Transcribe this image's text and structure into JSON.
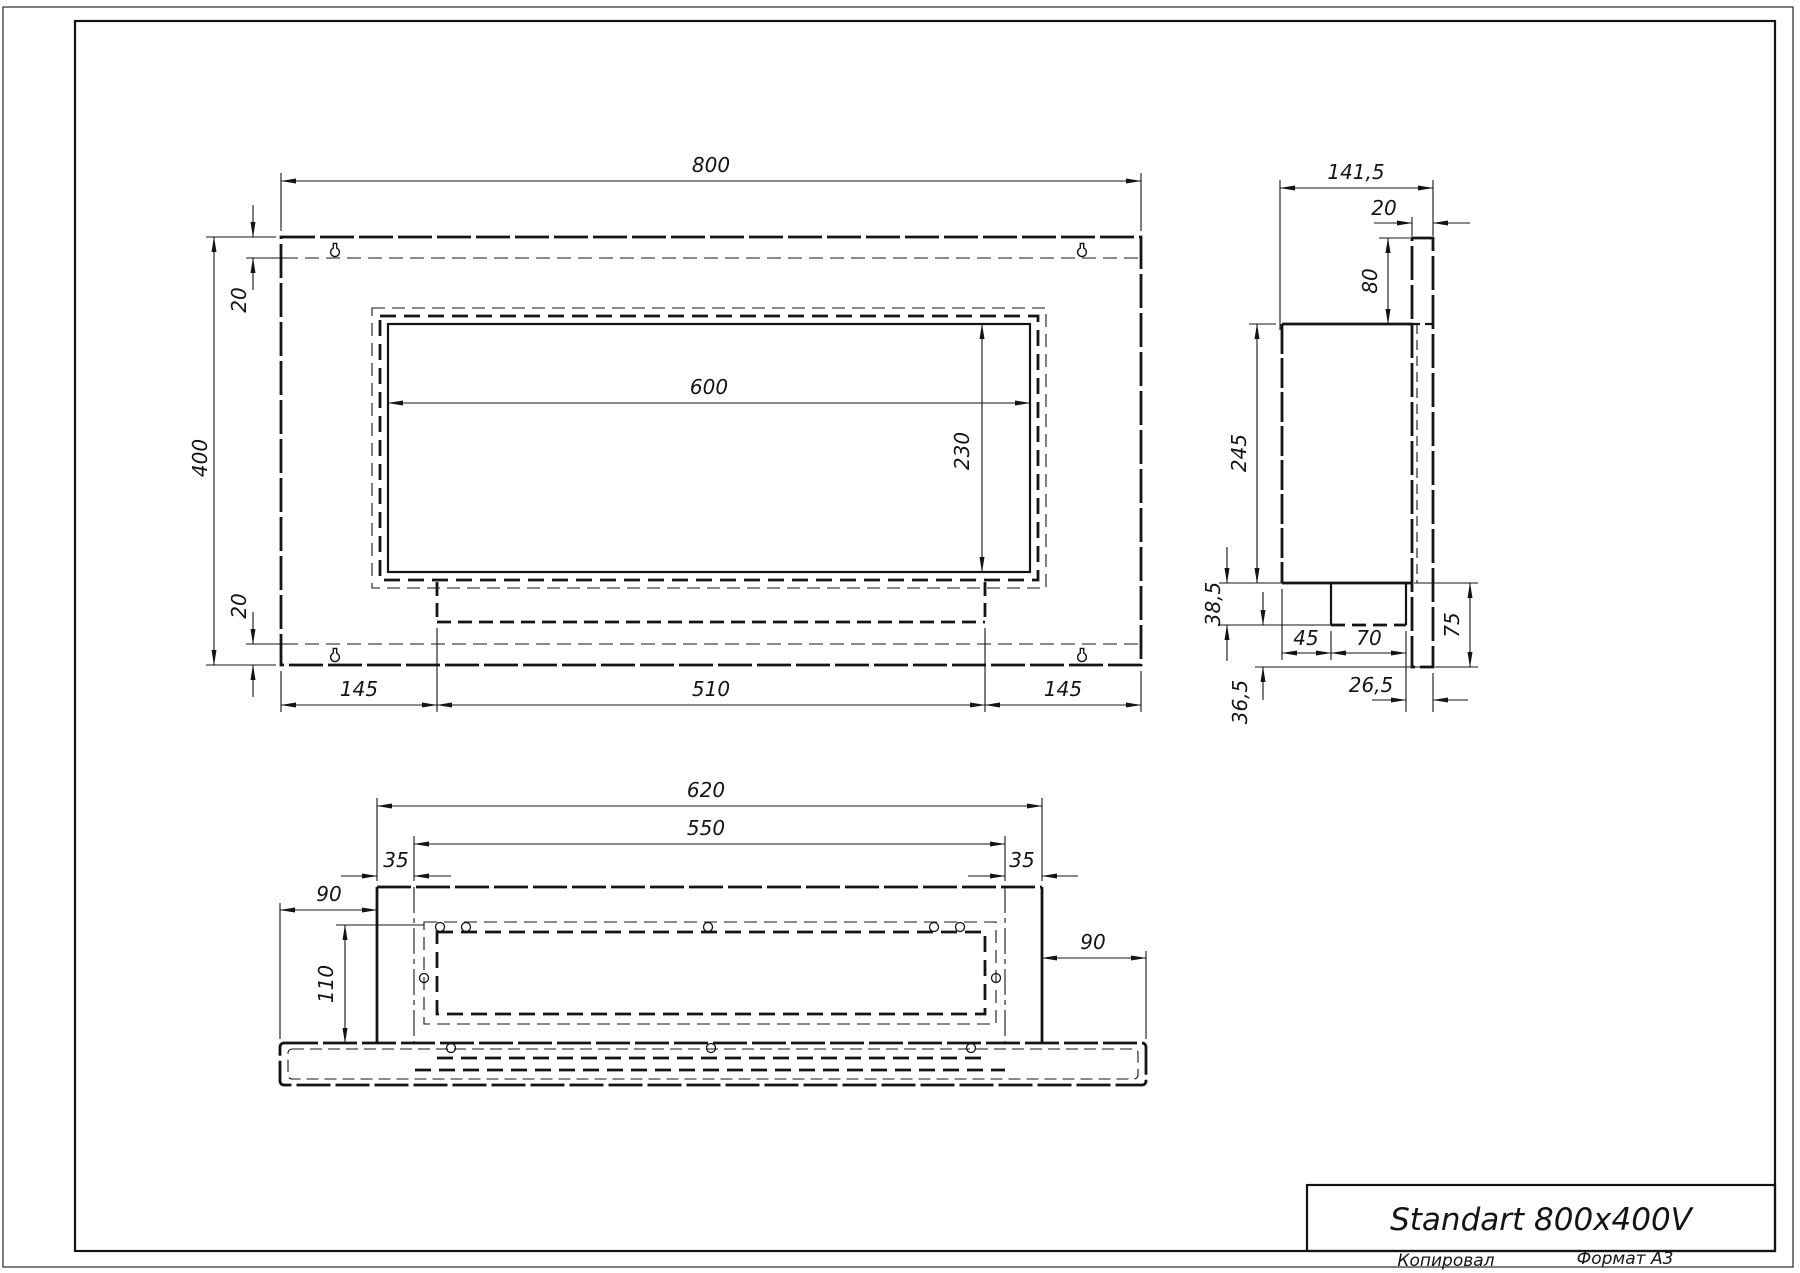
{
  "title_block": {
    "title": "Standart 800x400V",
    "copied_label": "Копировал",
    "format_label": "Формат А3"
  },
  "views": {
    "front": {
      "dims": {
        "width": "800",
        "height": "400",
        "wall_top": "20",
        "wall_bottom": "20",
        "opening_width": "600",
        "opening_height": "230",
        "left_margin": "145",
        "burner_width": "510",
        "right_margin": "145"
      }
    },
    "side": {
      "dims": {
        "total_depth": "141,5",
        "plate_thickness": "20",
        "plate_top_offset": "80",
        "box_height": "245",
        "tray_height": "38,5",
        "tray_offset": "45",
        "tray_depth": "70",
        "plate_bottom_offset": "75",
        "tray_to_plate": "26,5",
        "bottom_offset": "36,5"
      }
    },
    "bottom": {
      "dims": {
        "body_width": "620",
        "inner_width": "550",
        "inset_left": "35",
        "inset_right": "35",
        "flange_left": "90",
        "flange_right": "90",
        "depth": "110"
      }
    }
  }
}
